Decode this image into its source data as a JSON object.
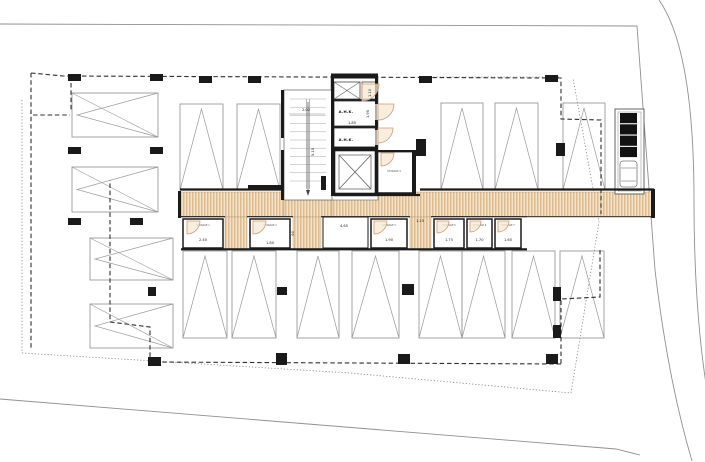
{
  "plan": {
    "title": "basement-parking-floor-plan",
    "labels": {
      "ahk_room_1": "A.H.K.",
      "ahk_room_2": "A.H.K.",
      "storage_room_4": "STORAGE 4"
    },
    "dims": {
      "stair_width": "2.02",
      "stair_run": "5.15",
      "duct": "1.10",
      "ahk_width": "1.85",
      "ahk_depth": "1.95",
      "bay_width": "4.65",
      "passage_width": "1.25"
    },
    "storages": [
      {
        "label": "STORAGE 1",
        "dim": "2.40"
      },
      {
        "label": "STORAGE 2",
        "dim": "1.80",
        "side_dim": ".90"
      },
      {
        "label": "STORAGE 3",
        "dim": "1.90"
      },
      {
        "label": "STORAGE 5",
        "dim": "1.75"
      },
      {
        "label": "STORAGE 6",
        "dim": "1.70"
      },
      {
        "label": "STORAGE 7",
        "dim": "1.60"
      }
    ],
    "parking": {
      "horizontal_stalls": 4,
      "vertical_stalls_top": 5,
      "vertical_stalls_bottom": 8
    },
    "colors": {
      "hatch_fill": "#f4e3c6",
      "hatch_stripe": "#cf9f6b",
      "wall": "#1a1a1a",
      "outline": "#8f8f8f",
      "dashed": "#2f2f2f",
      "dotted": "#808080",
      "stall": "#9a9a9a",
      "door": "#d49a6e",
      "door_fill": "#f6e8d2",
      "dim_text": "#222222"
    }
  }
}
